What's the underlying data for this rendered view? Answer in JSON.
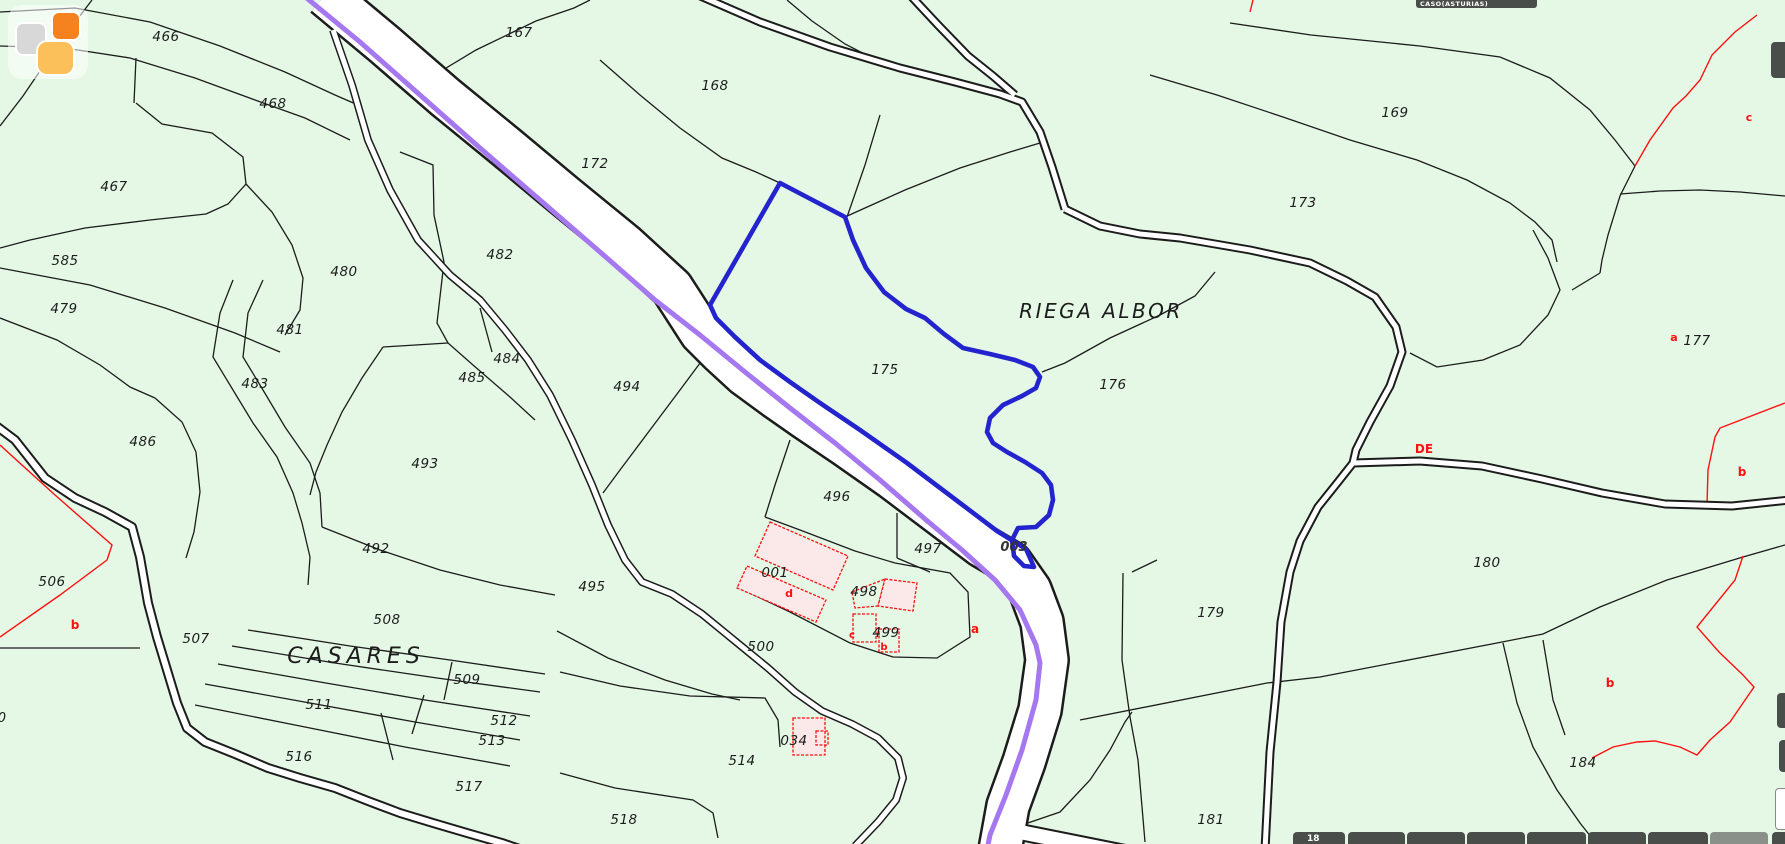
{
  "header": {
    "municipality": "CASO(ASTURIAS)"
  },
  "colors": {
    "background": "#e4f8e5",
    "parcel_line": "#1c1c1c",
    "red_line": "#fe1010",
    "highlight_blue": "#2424cf",
    "route_purple": "#a678f0",
    "road_white": "#ffffff",
    "building_fill": "#fbe9e9",
    "toolbar_dark": "#4a4e4a",
    "toolbar_light": "#8a918a",
    "logo_gray": "#d8d8d8",
    "logo_orange": "#f5821f",
    "logo_amber": "#fbc05a",
    "label_text": "#1c1c1c",
    "road_label_text": "#333333"
  },
  "map": {
    "place_names": [
      {
        "text": "RIEGA ALBOR",
        "x": 1101,
        "y": 318,
        "size": 20,
        "spacing": 2.5
      },
      {
        "text": "CASARES",
        "x": 356,
        "y": 663,
        "size": 22,
        "spacing": 5
      }
    ],
    "parcel_labels": [
      {
        "text": "466",
        "x": 166,
        "y": 41
      },
      {
        "text": "468",
        "x": 273,
        "y": 108
      },
      {
        "text": "467",
        "x": 114,
        "y": 191
      },
      {
        "text": "585",
        "x": 65,
        "y": 265
      },
      {
        "text": "167",
        "x": 519,
        "y": 37
      },
      {
        "text": "172",
        "x": 595,
        "y": 168
      },
      {
        "text": "168",
        "x": 715,
        "y": 90
      },
      {
        "text": "169",
        "x": 1395,
        "y": 117
      },
      {
        "text": "173",
        "x": 1303,
        "y": 207
      },
      {
        "text": "479",
        "x": 64,
        "y": 313
      },
      {
        "text": "480",
        "x": 344,
        "y": 276
      },
      {
        "text": "482",
        "x": 500,
        "y": 259
      },
      {
        "text": "481",
        "x": 290,
        "y": 334
      },
      {
        "text": "483",
        "x": 255,
        "y": 388
      },
      {
        "text": "484",
        "x": 507,
        "y": 363
      },
      {
        "text": "485",
        "x": 472,
        "y": 382
      },
      {
        "text": "486",
        "x": 143,
        "y": 446
      },
      {
        "text": "493",
        "x": 425,
        "y": 468
      },
      {
        "text": "492",
        "x": 376,
        "y": 553
      },
      {
        "text": "494",
        "x": 627,
        "y": 391
      },
      {
        "text": "175",
        "x": 885,
        "y": 374
      },
      {
        "text": "176",
        "x": 1113,
        "y": 389
      },
      {
        "text": "177",
        "x": 1697,
        "y": 345
      },
      {
        "text": "496",
        "x": 837,
        "y": 501
      },
      {
        "text": "497",
        "x": 928,
        "y": 553
      },
      {
        "text": "001",
        "x": 775,
        "y": 577
      },
      {
        "text": "498",
        "x": 864,
        "y": 596
      },
      {
        "text": "499",
        "x": 886,
        "y": 637
      },
      {
        "text": "495",
        "x": 592,
        "y": 591
      },
      {
        "text": "500",
        "x": 761,
        "y": 651
      },
      {
        "text": "506",
        "x": 52,
        "y": 586
      },
      {
        "text": "507",
        "x": 196,
        "y": 643
      },
      {
        "text": "508",
        "x": 387,
        "y": 624
      },
      {
        "text": "509",
        "x": 467,
        "y": 684
      },
      {
        "text": "511",
        "x": 319,
        "y": 709
      },
      {
        "text": "512",
        "x": 504,
        "y": 725
      },
      {
        "text": "513",
        "x": 492,
        "y": 745
      },
      {
        "text": "516",
        "x": 299,
        "y": 761
      },
      {
        "text": "517",
        "x": 469,
        "y": 791
      },
      {
        "text": "514",
        "x": 742,
        "y": 765
      },
      {
        "text": "518",
        "x": 624,
        "y": 824
      },
      {
        "text": "034",
        "x": 794,
        "y": 745
      },
      {
        "text": "179",
        "x": 1211,
        "y": 617
      },
      {
        "text": "180",
        "x": 1487,
        "y": 567
      },
      {
        "text": "181",
        "x": 1211,
        "y": 824
      },
      {
        "text": "184",
        "x": 1583,
        "y": 767
      },
      {
        "text": "0",
        "x": 2,
        "y": 722
      }
    ],
    "road_label": {
      "text": "003",
      "x": 1014,
      "y": 551
    },
    "red_letters": [
      {
        "text": "c",
        "x": 1749,
        "y": 121,
        "size": 11
      },
      {
        "text": "a",
        "x": 1674,
        "y": 341,
        "size": 11
      },
      {
        "text": "DE",
        "x": 1424,
        "y": 453,
        "size": 12
      },
      {
        "text": "b",
        "x": 1742,
        "y": 476,
        "size": 12
      },
      {
        "text": "b",
        "x": 1610,
        "y": 687,
        "size": 12
      },
      {
        "text": "b",
        "x": 75,
        "y": 629,
        "size": 12
      },
      {
        "text": "a",
        "x": 975,
        "y": 633,
        "size": 12
      },
      {
        "text": "d",
        "x": 789,
        "y": 597,
        "size": 11
      },
      {
        "text": "c",
        "x": 852,
        "y": 638,
        "size": 10
      },
      {
        "text": "b",
        "x": 884,
        "y": 650,
        "size": 10
      }
    ],
    "lines_black": [
      "0,12 75,8 150,22 220,46 285,72 335,95 358,105",
      "0,46 65,48 130,58 195,78 255,100 305,118 350,140",
      "92,0 57,46 23,96 0,126",
      "136,58 134,103",
      "136,103 162,124 212,133 243,157 246,184 228,204 206,214",
      "206,214 150,220 85,228 30,240 0,248",
      "0,268 90,285 165,308 235,333 280,352",
      "0,318 57,340 100,365 130,387 155,398",
      "155,398 182,422 196,452 200,492 194,532 186,558",
      "233,280 220,313 213,357 233,390 253,423 277,457 293,493 302,523 310,557 308,585",
      "263,280 248,313 243,357 263,390 285,427 310,463 320,493 322,527",
      "383,347 362,378 342,412 327,445 316,472 310,495",
      "400,152 433,165 434,215 444,262 437,323 448,343 473,365 510,397 535,420",
      "448,343 383,347",
      "480,308 492,352",
      "246,184 272,212 292,245 303,278 300,310 285,335",
      "322,527 380,550 440,570 500,585 555,595",
      "712,347 680,390 650,430 620,470 603,493",
      "600,60 640,95 680,128 722,158 756,172 780,183",
      "413,88 476,50 536,21 574,8 590,0",
      "787,0 812,21 845,44 880,62 900,70",
      "845,217 905,190 960,168 1010,152 1040,143",
      "880,115 865,165 847,217",
      "1042,372 1065,363 1110,338 1160,315 1195,296 1215,272",
      "790,440 775,485 765,517",
      "765,517 800,530 855,551 895,563",
      "897,513 897,558",
      "897,558 930,572",
      "895,563 950,573 968,592 970,637 937,658 893,657 850,643 790,612 737,587",
      "557,631 608,658 665,680 712,694 740,700",
      "560,672 620,686 690,696 765,698 778,720 780,747",
      "560,773 615,788 693,800 713,813 718,838",
      "0,648 140,648",
      "248,630 350,646 450,660 545,674",
      "232,646 335,663 437,678 540,692",
      "218,664 320,682 425,700 530,716",
      "205,684 310,703 415,722 520,740",
      "195,705 300,726 405,747 510,766",
      "452,662 444,700",
      "424,695 412,734",
      "381,713 393,760",
      "1080,720 1267,683 1320,677 1497,643 1543,634 1600,607 1667,580 1743,557 1785,545",
      "1123,573 1122,660 1130,717 1138,760 1145,842",
      "1132,572 1157,560",
      "1503,643 1517,703 1533,747 1557,790 1580,823 1595,842",
      "1543,640 1553,700 1565,735",
      "1022,825 1060,812 1090,780 1110,750 1125,722 1132,712",
      "1410,353 1437,367 1483,360 1520,345 1548,315 1560,290 1548,258 1533,230",
      "1572,290 1600,273",
      "1635,166 1620,196 1608,235 1602,260 1600,273",
      "1620,194 1660,191 1700,190 1740,192 1785,196",
      "1230,23 1311,35 1420,46 1500,57 1550,78 1590,110 1615,140 1635,166",
      "1150,75 1217,95 1283,117 1350,140 1417,160 1467,180 1510,203 1535,222 1552,240 1557,262"
    ],
    "lines_red": [
      "1757,15 1735,32 1712,55 1700,80 1686,96 1673,108 1650,140 1635,166",
      "1785,403 1720,428 1715,437 1708,470 1707,505",
      "1743,556 1735,580 1697,627 1719,652 1743,675 1754,687 1743,703 1730,722 1710,740 1697,755 1680,747 1655,741 1637,742 1613,747 1592,758",
      "0,445 55,495 112,545 107,560 60,595 0,637",
      "1253,0 1250,12"
    ],
    "roads": [
      {
        "name": "main-road",
        "pts": "325,-5 385,45 445,97 505,146 565,196 625,245 672,288 701,333 720,352 745,375 775,397 805,418 845,445 892,478 945,518 982,546 1011,563 1030,590 1042,622 1047,660 1040,710 1024,762 1008,806 1000,850",
        "outer": 46,
        "inner": 41
      },
      {
        "name": "bottom-spur-road",
        "pts": "1000,828 1050,838 1110,850 1150,858",
        "outer": 18,
        "inner": 14
      },
      {
        "name": "path-nw-a",
        "pts": "698,-5 760,22 830,47 900,68 955,82 1000,94 1022,102 1040,132 1052,167 1065,209",
        "outer": 9,
        "inner": 5
      },
      {
        "name": "path-nw-b",
        "pts": "910,-5 938,25 968,56 993,76 1015,95",
        "outer": 9,
        "inner": 5
      },
      {
        "name": "path-east-main",
        "pts": "1065,209 1100,226 1140,234 1180,238 1250,250 1310,263 1347,281 1375,297 1396,327 1402,352 1390,386 1370,422 1356,450 1353,463",
        "outer": 9,
        "inner": 5
      },
      {
        "name": "path-south-branch",
        "pts": "1353,463 1338,482 1318,507 1300,541 1290,572 1281,622 1277,682 1270,752 1265,850",
        "outer": 9,
        "inner": 5
      },
      {
        "name": "path-east-branch",
        "pts": "1353,463 1420,461 1482,466 1542,479 1602,493 1665,504 1732,506 1790,500",
        "outer": 9,
        "inner": 5
      },
      {
        "name": "path-middle",
        "pts": "333,30 352,85 368,140 390,190 418,240 450,275 480,300 505,330 528,360 550,395 572,440 592,485 608,525 625,560 642,582 672,594 702,614 735,641 768,668 795,692 822,711 852,724 878,738 898,758 903,778 896,800 878,822 855,846",
        "outer": 8,
        "inner": 5
      },
      {
        "name": "path-casares",
        "pts": "-5,425 15,440 45,478 75,498 105,512 132,527 140,557 148,603 157,637 167,670 177,703 187,728 205,742 235,754 268,768 300,778 335,788 368,801 400,813 433,823 467,833 502,843 540,856",
        "outer": 10,
        "inner": 6
      }
    ],
    "purple_route": "303,-5 360,42 420,95 480,148 540,200 600,252 655,300 700,335 745,372 790,408 835,443 880,480 925,519 962,550 995,580 1020,610 1036,645 1040,663 1036,700 1022,750 1006,795 990,835 987,850",
    "highlight_parcel": "780,183 845,217 853,240 866,268 884,292 906,309 925,318 944,334 963,348 990,354 1015,360 1033,367 1040,377 1036,388 1022,396 1003,405 990,418 987,432 993,443 1007,452 1025,462 1042,473 1051,485 1053,500 1049,515 1036,527 1018,528 1012,540 1014,556 1024,566 1034,567 1026,549 997,531 960,503 907,463 860,430 820,403 790,382 760,360 735,337 716,318 710,305",
    "buildings": [
      {
        "pts": "770,522 848,556 833,590 755,556",
        "filled": true
      },
      {
        "pts": "747,566 826,600 816,622 737,588",
        "filled": true
      },
      {
        "pts": "852,592 885,579 878,606 855,608",
        "filled": false
      },
      {
        "pts": "885,579 917,583 913,611 878,606",
        "filled": true
      },
      {
        "pts": "853,614 876,614 876,642 853,642",
        "filled": false
      },
      {
        "pts": "879,629 899,629 899,652 879,652",
        "filled": false
      },
      {
        "pts": "793,718 825,718 825,755 793,755",
        "filled": true
      },
      {
        "pts": "816,731 828,731 828,745 816,745",
        "filled": false
      }
    ]
  },
  "logo": {
    "x": 8,
    "y": 5
  },
  "titlebar": {
    "x": 1416,
    "width": 113
  },
  "bottom_toolbar": {
    "segments": [
      {
        "x": 1293,
        "w": 52,
        "light": false,
        "label": "18"
      },
      {
        "x": 1348,
        "w": 57,
        "light": false,
        "label": ""
      },
      {
        "x": 1407,
        "w": 58,
        "light": false,
        "label": ""
      },
      {
        "x": 1467,
        "w": 58,
        "light": false,
        "label": ""
      },
      {
        "x": 1527,
        "w": 59,
        "light": false,
        "label": ""
      },
      {
        "x": 1588,
        "w": 58,
        "light": false,
        "label": ""
      },
      {
        "x": 1648,
        "w": 60,
        "light": false,
        "label": ""
      },
      {
        "x": 1710,
        "w": 58,
        "light": true,
        "label": ""
      },
      {
        "x": 1772,
        "w": 20,
        "light": false,
        "label": ""
      }
    ]
  },
  "edge_tabs": [
    {
      "x": 1771,
      "y": 42,
      "w": 20,
      "h": 36,
      "light": false
    },
    {
      "x": 1777,
      "y": 693,
      "w": 16,
      "h": 35,
      "light": false
    },
    {
      "x": 1779,
      "y": 740,
      "w": 14,
      "h": 32,
      "light": false
    },
    {
      "x": 1775,
      "y": 788,
      "w": 18,
      "h": 40,
      "light": true
    }
  ]
}
